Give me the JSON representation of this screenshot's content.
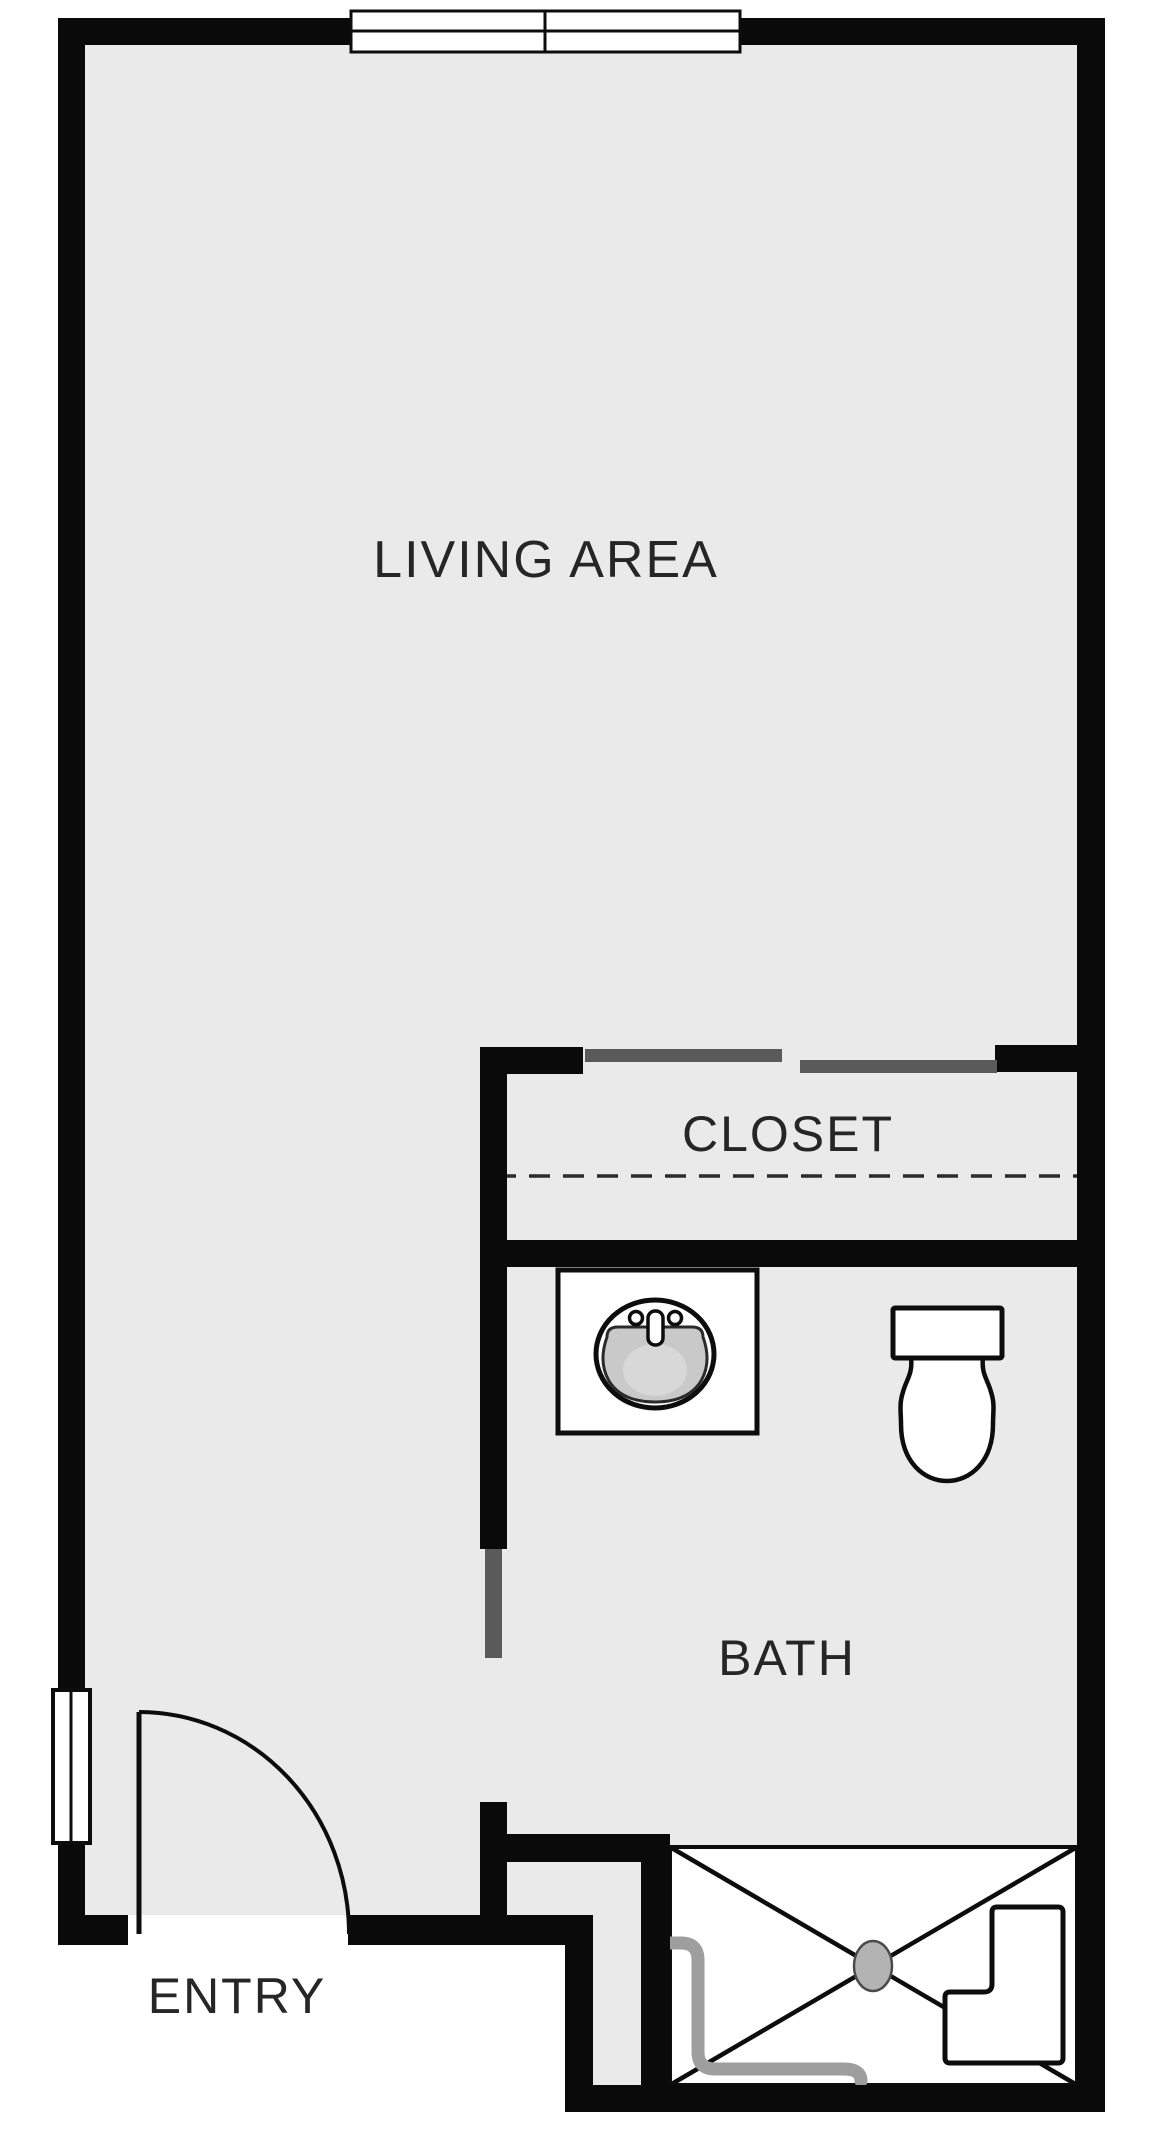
{
  "colors": {
    "exterior": "#ffffff",
    "floor": "#eaeaea",
    "wall": "#0a0a0a",
    "fixture": "#0d0d0d",
    "label": "#262626",
    "door": "#5a5a5a",
    "curtain": "#9e9e9e",
    "drain": "#b3b3b3",
    "basin": "#c9c9c9",
    "dash": "#2b2b2b"
  },
  "rooms": {
    "living_area": {
      "label": "LIVING AREA"
    },
    "closet": {
      "label": "CLOSET"
    },
    "bath": {
      "label": "BATH"
    },
    "entry": {
      "label": "ENTRY"
    }
  },
  "fixtures": {
    "top_window": "double-pane-window",
    "side_window": "sidelight-window",
    "entry_door": "entry-swing-door",
    "bath_door": "bath-door-panel",
    "closet_doors": "sliding-bypass-doors",
    "closet_rod": "closet-rod-dashed-line",
    "sink": "vanity-sink",
    "toilet": "toilet",
    "shower": "walk-in-shower",
    "shower_drain": "shower-drain",
    "shower_curtain": "shower-curtain-track",
    "shower_bench": "shower-bench"
  }
}
